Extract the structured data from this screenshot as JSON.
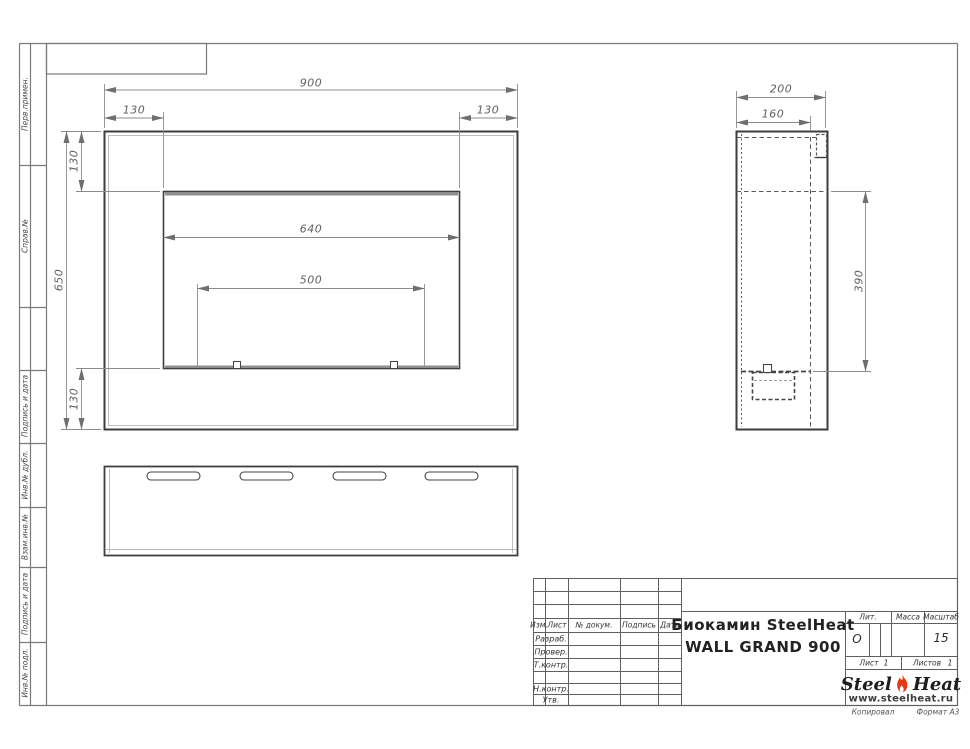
{
  "margin_labels": {
    "perv_primen": "Перв.примен.",
    "sprav_no": "Справ.№",
    "podpis_data_1": "Подпись и дата",
    "inv_dubl": "Инв.№ дубл.",
    "vzam_inv": "Взам.инв.№",
    "podpis_data_2": "Подпись и дата",
    "inv_podl": "Инв.№ подл."
  },
  "dims": {
    "front": {
      "total_width": "900",
      "left_offset": "130",
      "right_offset": "130",
      "total_height": "650",
      "top_offset": "130",
      "bottom_offset": "130",
      "opening_width": "640",
      "burner_width": "500"
    },
    "side": {
      "total_depth": "200",
      "inner_depth": "160",
      "opening_height": "390"
    }
  },
  "title_block": {
    "cols": {
      "izm": "Изм.",
      "list": "Лист",
      "doc": "№ докум.",
      "podpis": "Подпись",
      "data": "Дата"
    },
    "rows": {
      "razrab": "Разраб.",
      "prover": "Провер.",
      "tkontr": "Т.контр.",
      "nkontr": "Н.контр.",
      "utv": "Утв."
    },
    "title_line1": "Биокамин SteelHeat",
    "title_line2": "WALL GRAND 900",
    "lit_label": "Лит.",
    "lit_value": "О",
    "mass_label": "Масса",
    "scale_label": "Масштаб",
    "scale_value": "15",
    "list_label": "Лист",
    "list_value": "1",
    "listov_label": "Листов",
    "listov_value": "1"
  },
  "logo": {
    "steel": "Steel",
    "heat": "Heat",
    "site": "www.steelheat.ru"
  },
  "footer": {
    "kopiroval": "Копировал",
    "format": "Формат А3"
  }
}
